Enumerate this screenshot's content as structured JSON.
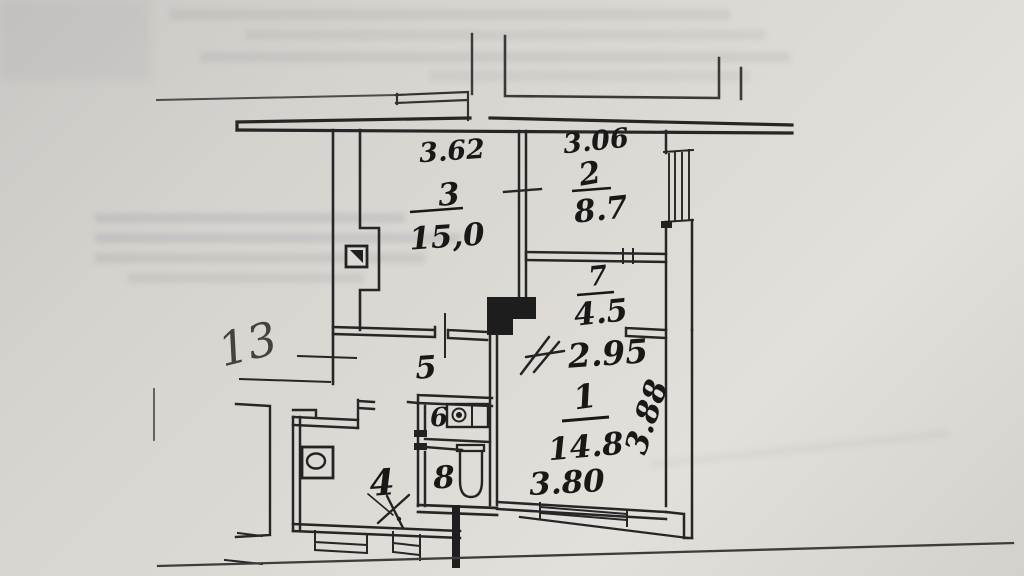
{
  "plan": {
    "page_marker": "13",
    "dims": {
      "room3_width": "3.62",
      "room2_width": "3.06",
      "hall_width": "2.95",
      "room1_width": "3.80",
      "room1_depth": "3.88"
    },
    "rooms": {
      "room1": {
        "number": "1",
        "area": "14.8"
      },
      "room2": {
        "number": "2",
        "area": "8.7"
      },
      "room3": {
        "number": "3",
        "area": "15,0"
      },
      "room4": {
        "number": "4"
      },
      "room5": {
        "number": "5"
      },
      "room6": {
        "number": "6"
      },
      "room7": {
        "number": "7",
        "area": "4.5"
      },
      "room8": {
        "number": "8"
      }
    }
  }
}
